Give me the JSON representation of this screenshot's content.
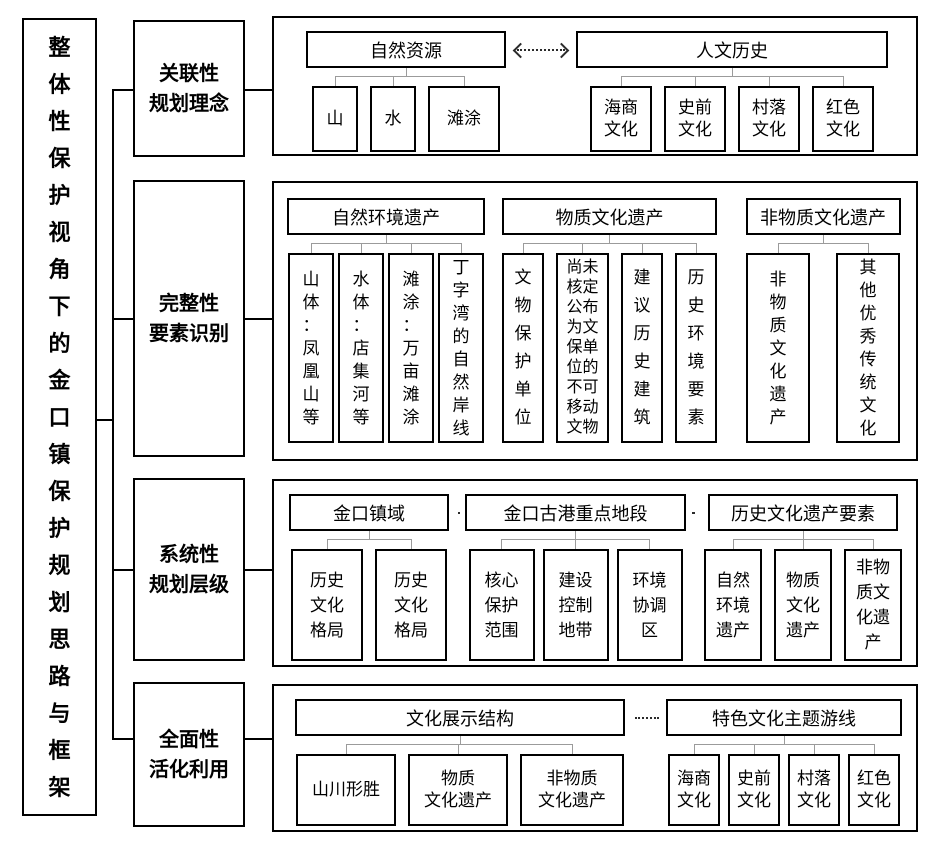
{
  "root_title": "整体性保护视角下的金口镇保护规划思路与框架",
  "colors": {
    "box_border": "#000000",
    "tree_connector": "#9b9b9b",
    "dotted_link": "#2b2b2b",
    "background": "#ffffff"
  },
  "sections": [
    {
      "label": "关联性\n规划理念",
      "groups": [
        {
          "header": "自然资源",
          "children": [
            "山",
            "水",
            "滩涂"
          ]
        },
        {
          "header": "人文历史",
          "children": [
            "海商文化",
            "史前文化",
            "村落文化",
            "红色文化"
          ]
        }
      ],
      "link_style": "double-dashed-arrow"
    },
    {
      "label": "完整性\n要素识别",
      "groups": [
        {
          "header": "自然环境遗产",
          "children": [
            "山体：凤凰山等",
            "水体：店集河等",
            "滩涂：万亩滩涂",
            "丁字湾的自然岸线"
          ]
        },
        {
          "header": "物质文化遗产",
          "children": [
            "文物保护单位",
            "尚未核定公布为文保单位的不可移动文物",
            "建议历史建筑",
            "历史环境要素"
          ]
        },
        {
          "header": "非物质文化遗产",
          "children": [
            "非物质文化遗产",
            "其他优秀传统文化"
          ]
        }
      ],
      "link_style": "dotted"
    },
    {
      "label": "系统性\n规划层级",
      "groups": [
        {
          "header": "金口镇域",
          "children": [
            "历史文化格局",
            "历史文化格局"
          ]
        },
        {
          "header": "金口古港重点地段",
          "children": [
            "核心保护范围",
            "建设控制地带",
            "环境协调区"
          ]
        },
        {
          "header": "历史文化遗产要素",
          "children": [
            "自然环境遗产",
            "物质文化遗产",
            "非物质文化遗产"
          ]
        }
      ],
      "link_style": "dotted"
    },
    {
      "label": "全面性\n活化利用",
      "groups": [
        {
          "header": "文化展示结构",
          "children": [
            "山川形胜",
            "物质\n文化遗产",
            "非物质\n文化遗产"
          ]
        },
        {
          "header": "特色文化主题游线",
          "children": [
            "海商文化",
            "史前文化",
            "村落文化",
            "红色文化"
          ]
        }
      ],
      "link_style": "dotted"
    }
  ]
}
